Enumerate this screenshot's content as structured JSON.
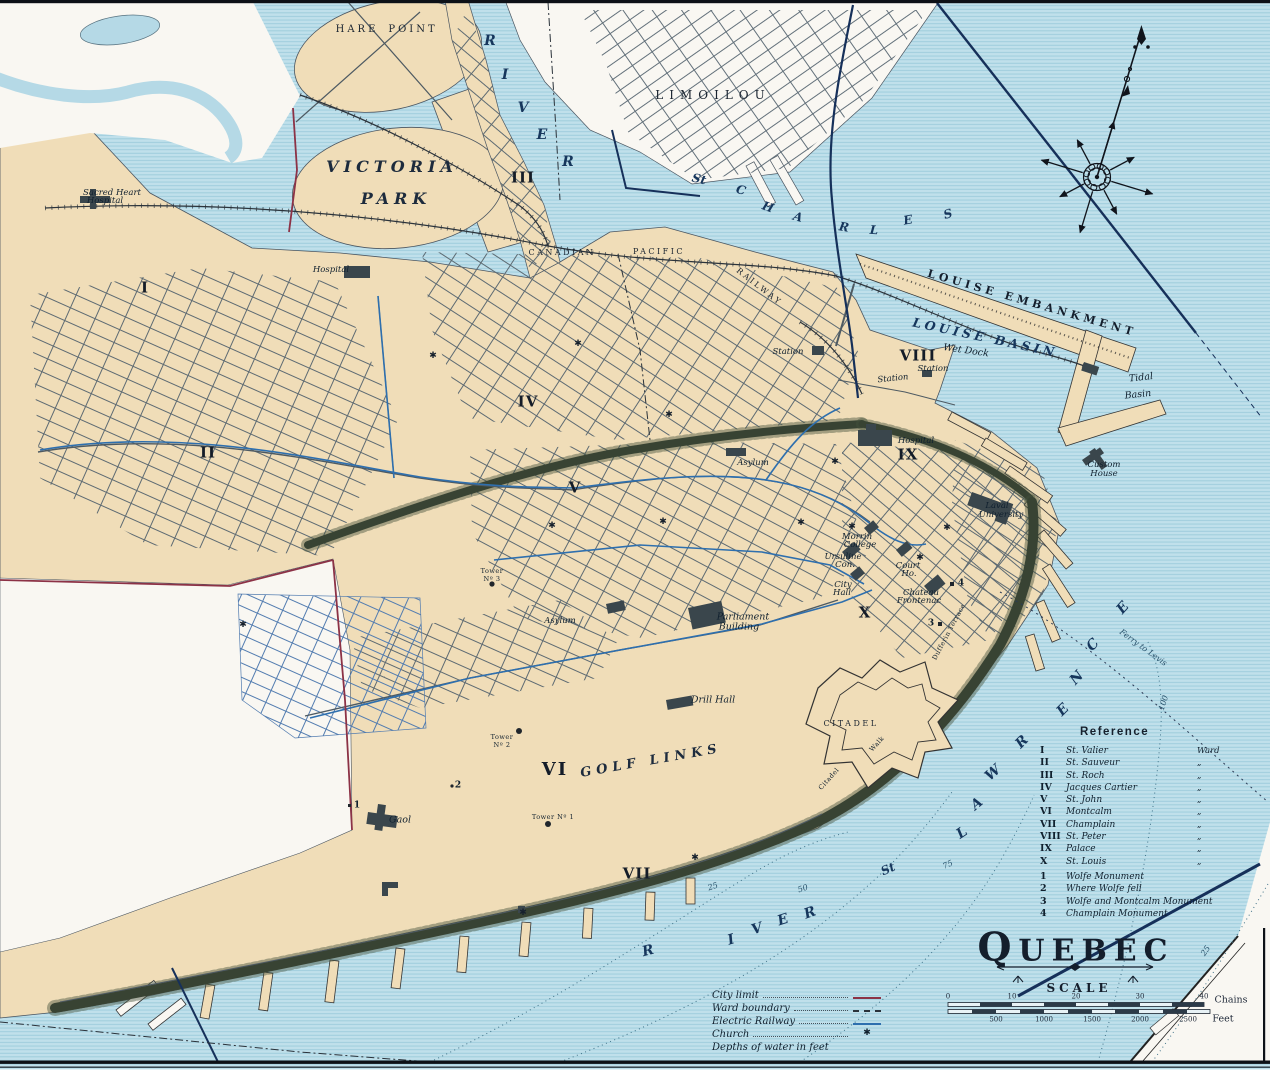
{
  "map": {
    "title": "QUEBEC",
    "scale_heading": "SCALE",
    "scale_bar": {
      "chains_ticks": [
        "0",
        "10",
        "20",
        "30",
        "40"
      ],
      "chains_unit": "Chains",
      "feet_ticks": [
        "500",
        "1000",
        "1500",
        "2000",
        "2500"
      ],
      "feet_unit": "Feet"
    },
    "colors": {
      "water": "#c0e0eb",
      "water_line": "#99cadb",
      "land": "#f0ddb8",
      "white_area": "#f9f7f2",
      "cliff": "#2e382c",
      "ink": "#1e2838",
      "electric_railway": "#2e6fae",
      "city_limit": "#8c3246",
      "navy": "#16305a"
    },
    "legend": [
      {
        "label": "City limit",
        "swatch": "maroon"
      },
      {
        "label": "Ward boundary",
        "swatch": "dash"
      },
      {
        "label": "Electric Railway",
        "swatch": "blue"
      },
      {
        "label": "Church",
        "swatch": "church"
      },
      {
        "label": "Depths of water in feet",
        "swatch": "none"
      }
    ],
    "reference": {
      "heading": "Reference",
      "wards": [
        {
          "numeral": "I",
          "name": "St. Valier",
          "suffix": "Ward"
        },
        {
          "numeral": "II",
          "name": "St. Sauveur",
          "suffix": "„"
        },
        {
          "numeral": "III",
          "name": "St. Roch",
          "suffix": "„"
        },
        {
          "numeral": "IV",
          "name": "Jacques Cartier",
          "suffix": "„"
        },
        {
          "numeral": "V",
          "name": "St. John",
          "suffix": "„"
        },
        {
          "numeral": "VI",
          "name": "Montcalm",
          "suffix": "„"
        },
        {
          "numeral": "VII",
          "name": "Champlain",
          "suffix": "„"
        },
        {
          "numeral": "VIII",
          "name": "St. Peter",
          "suffix": "„"
        },
        {
          "numeral": "IX",
          "name": "Palace",
          "suffix": "„"
        },
        {
          "numeral": "X",
          "name": "St. Louis",
          "suffix": "„"
        }
      ],
      "monuments": [
        {
          "num": "1",
          "name": "Wolfe Monument"
        },
        {
          "num": "2",
          "name": "Where Wolfe fell"
        },
        {
          "num": "3",
          "name": "Wolfe and Montcalm Monument"
        },
        {
          "num": "4",
          "name": "Champlain Monument"
        }
      ]
    },
    "churches": [
      [
        433,
        356
      ],
      [
        578,
        344
      ],
      [
        669,
        415
      ],
      [
        552,
        526
      ],
      [
        663,
        522
      ],
      [
        801,
        523
      ],
      [
        835,
        462
      ],
      [
        852,
        527
      ],
      [
        920,
        558
      ],
      [
        947,
        528
      ],
      [
        243,
        625
      ],
      [
        695,
        858
      ],
      [
        523,
        913
      ]
    ],
    "labels": [
      {
        "t": "HARE",
        "x": 357,
        "y": 30,
        "c": "dist10"
      },
      {
        "t": "POINT",
        "x": 413,
        "y": 30,
        "c": "dist10"
      },
      {
        "t": "VICTORIA",
        "x": 392,
        "y": 167,
        "c": "park"
      },
      {
        "t": "PARK",
        "x": 396,
        "y": 199,
        "c": "park"
      },
      {
        "t": "R",
        "x": 490,
        "y": 41,
        "c": "wl"
      },
      {
        "t": "I",
        "x": 505,
        "y": 75,
        "c": "wl"
      },
      {
        "t": "V",
        "x": 523,
        "y": 108,
        "c": "wl"
      },
      {
        "t": "E",
        "x": 542,
        "y": 135,
        "c": "wl"
      },
      {
        "t": "R",
        "x": 568,
        "y": 162,
        "c": "wl"
      },
      {
        "t": "III",
        "x": 523,
        "y": 178,
        "c": "ward"
      },
      {
        "t": "LIMOILOU",
        "x": 713,
        "y": 95,
        "c": "dist12"
      },
      {
        "t": "St",
        "x": 699,
        "y": 179,
        "c": "wl2",
        "r": 12
      },
      {
        "t": "C",
        "x": 741,
        "y": 190,
        "c": "wl2",
        "r": 16
      },
      {
        "t": "H",
        "x": 768,
        "y": 207,
        "c": "wl2",
        "r": 20
      },
      {
        "t": "A",
        "x": 798,
        "y": 217,
        "c": "wl2",
        "r": 16
      },
      {
        "t": "R",
        "x": 844,
        "y": 227,
        "c": "wl2",
        "r": 10
      },
      {
        "t": "L",
        "x": 874,
        "y": 230,
        "c": "wl2",
        "r": 4
      },
      {
        "t": "E",
        "x": 908,
        "y": 220,
        "c": "wl2",
        "r": -10
      },
      {
        "t": "S",
        "x": 948,
        "y": 214,
        "c": "wl2",
        "r": -16
      },
      {
        "t": "CANADIAN",
        "x": 562,
        "y": 253,
        "c": "dist8"
      },
      {
        "t": "PACIFIC",
        "x": 659,
        "y": 252,
        "c": "dist8"
      },
      {
        "t": "RAILWAY",
        "x": 759,
        "y": 287,
        "c": "dist8",
        "r": 38
      },
      {
        "t": "Station",
        "x": 788,
        "y": 352,
        "c": "place8"
      },
      {
        "t": "Station",
        "x": 893,
        "y": 379,
        "c": "place8",
        "r": -6
      },
      {
        "t": "VIII",
        "x": 918,
        "y": 356,
        "c": "ward"
      },
      {
        "t": "Station",
        "x": 933,
        "y": 369,
        "c": "place8"
      },
      {
        "t": "LOUISE  EMBANKMENT",
        "x": 1032,
        "y": 303,
        "c": "emb",
        "r": 16
      },
      {
        "t": "LOUISE  BASIN",
        "x": 985,
        "y": 338,
        "c": "wm",
        "r": 12
      },
      {
        "t": "Wet Dock",
        "x": 966,
        "y": 351,
        "c": "place",
        "r": 8
      },
      {
        "t": "Tidal",
        "x": 1141,
        "y": 378,
        "c": "place",
        "r": -6
      },
      {
        "t": "Basin",
        "x": 1138,
        "y": 395,
        "c": "place",
        "r": -6
      },
      {
        "t": "Custom",
        "x": 1104,
        "y": 465,
        "c": "place8"
      },
      {
        "t": "House",
        "x": 1104,
        "y": 474,
        "c": "place8"
      },
      {
        "t": "Hospital",
        "x": 916,
        "y": 441,
        "c": "place8"
      },
      {
        "t": "IX",
        "x": 908,
        "y": 455,
        "c": "ward"
      },
      {
        "t": "Laval",
        "x": 997,
        "y": 506,
        "c": "place8"
      },
      {
        "t": "University",
        "x": 1001,
        "y": 515,
        "c": "place8"
      },
      {
        "t": "Asylum",
        "x": 753,
        "y": 463,
        "c": "place8"
      },
      {
        "t": "Morrin",
        "x": 857,
        "y": 537,
        "c": "place8"
      },
      {
        "t": "College",
        "x": 860,
        "y": 545,
        "c": "place8"
      },
      {
        "t": "Ursuline",
        "x": 843,
        "y": 557,
        "c": "place8"
      },
      {
        "t": "Con.",
        "x": 845,
        "y": 565,
        "c": "place8"
      },
      {
        "t": "Court",
        "x": 908,
        "y": 566,
        "c": "place8"
      },
      {
        "t": "Ho.",
        "x": 909,
        "y": 574,
        "c": "place8"
      },
      {
        "t": "City",
        "x": 843,
        "y": 585,
        "c": "place8"
      },
      {
        "t": "Hall",
        "x": 842,
        "y": 593,
        "c": "place8"
      },
      {
        "t": "Chateau",
        "x": 921,
        "y": 593,
        "c": "place8"
      },
      {
        "t": "Frontenac",
        "x": 919,
        "y": 601,
        "c": "place8"
      },
      {
        "t": "4",
        "x": 961,
        "y": 584,
        "c": "marker"
      },
      {
        "t": "3",
        "x": 931,
        "y": 624,
        "c": "marker"
      },
      {
        "t": "X",
        "x": 865,
        "y": 613,
        "c": "ward"
      },
      {
        "t": "Dufferin Terrace",
        "x": 949,
        "y": 632,
        "c": "tiny",
        "r": -62
      },
      {
        "t": "Parliament",
        "x": 743,
        "y": 617,
        "c": "place"
      },
      {
        "t": "Building",
        "x": 739,
        "y": 627,
        "c": "place"
      },
      {
        "t": "Asylum",
        "x": 560,
        "y": 621,
        "c": "place8"
      },
      {
        "t": "Drill Hall",
        "x": 713,
        "y": 700,
        "c": "place"
      },
      {
        "t": "CITADEL",
        "x": 851,
        "y": 724,
        "c": "dist8"
      },
      {
        "t": "Citadel",
        "x": 829,
        "y": 779,
        "c": "tiny",
        "r": -48
      },
      {
        "t": "Walk",
        "x": 877,
        "y": 744,
        "c": "tiny",
        "r": -48
      },
      {
        "t": "VI",
        "x": 555,
        "y": 770,
        "c": "wardlg"
      },
      {
        "t": "GOLF  LINKS",
        "x": 651,
        "y": 761,
        "c": "golf",
        "r": -10
      },
      {
        "t": "Tower",
        "x": 492,
        "y": 571,
        "c": "tiny"
      },
      {
        "t": "Nº 3",
        "x": 492,
        "y": 579,
        "c": "tiny"
      },
      {
        "t": "Tower",
        "x": 502,
        "y": 737,
        "c": "tiny"
      },
      {
        "t": "Nº 2",
        "x": 502,
        "y": 745,
        "c": "tiny"
      },
      {
        "t": "Tower Nº 1",
        "x": 553,
        "y": 817,
        "c": "tiny"
      },
      {
        "t": "Gaol",
        "x": 400,
        "y": 820,
        "c": "place"
      },
      {
        "t": "1",
        "x": 357,
        "y": 806,
        "c": "marker"
      },
      {
        "t": "2",
        "x": 458,
        "y": 786,
        "c": "marker"
      },
      {
        "t": "I",
        "x": 145,
        "y": 288,
        "c": "ward"
      },
      {
        "t": "II",
        "x": 208,
        "y": 453,
        "c": "ward"
      },
      {
        "t": "IV",
        "x": 528,
        "y": 402,
        "c": "ward"
      },
      {
        "t": "V",
        "x": 575,
        "y": 488,
        "c": "ward"
      },
      {
        "t": "VII",
        "x": 637,
        "y": 874,
        "c": "ward"
      },
      {
        "t": "Sacred Heart",
        "x": 112,
        "y": 193,
        "c": "place8"
      },
      {
        "t": "Hospital",
        "x": 105,
        "y": 201,
        "c": "place8"
      },
      {
        "t": "Hospital",
        "x": 331,
        "y": 270,
        "c": "place8"
      },
      {
        "t": "R",
        "x": 648,
        "y": 951,
        "c": "wl",
        "r": -14
      },
      {
        "t": "I",
        "x": 731,
        "y": 940,
        "c": "wl",
        "r": -16
      },
      {
        "t": "V",
        "x": 757,
        "y": 929,
        "c": "wl",
        "r": -18
      },
      {
        "t": "E",
        "x": 783,
        "y": 920,
        "c": "wl",
        "r": -18
      },
      {
        "t": "R",
        "x": 810,
        "y": 913,
        "c": "wl",
        "r": -20
      },
      {
        "t": "St",
        "x": 888,
        "y": 869,
        "c": "wl2",
        "r": -24
      },
      {
        "t": "L",
        "x": 962,
        "y": 833,
        "c": "wl",
        "r": -34
      },
      {
        "t": "A",
        "x": 977,
        "y": 804,
        "c": "wl",
        "r": -40
      },
      {
        "t": "W",
        "x": 993,
        "y": 773,
        "c": "wl",
        "r": -42
      },
      {
        "t": "R",
        "x": 1022,
        "y": 742,
        "c": "wl",
        "r": -45
      },
      {
        "t": "E",
        "x": 1063,
        "y": 710,
        "c": "wl",
        "r": -45
      },
      {
        "t": "N",
        "x": 1077,
        "y": 678,
        "c": "wl",
        "r": -47
      },
      {
        "t": "C",
        "x": 1093,
        "y": 645,
        "c": "wl",
        "r": -47
      },
      {
        "t": "E",
        "x": 1123,
        "y": 608,
        "c": "wl",
        "r": -48
      },
      {
        "t": "Ferry to Levis",
        "x": 1143,
        "y": 648,
        "c": "depth",
        "r": 36
      },
      {
        "t": "25",
        "x": 713,
        "y": 887,
        "c": "depth",
        "r": -18
      },
      {
        "t": "50",
        "x": 803,
        "y": 889,
        "c": "depth",
        "r": -18
      },
      {
        "t": "75",
        "x": 948,
        "y": 865,
        "c": "depth",
        "r": -25
      },
      {
        "t": "100",
        "x": 1164,
        "y": 703,
        "c": "depth",
        "r": -72
      },
      {
        "t": "25",
        "x": 1206,
        "y": 951,
        "c": "depth",
        "r": -55
      },
      {
        "t": "QUEBEC",
        "x": 1076,
        "y": 948,
        "c": "title",
        "n": "map-title"
      },
      {
        "t": "SCALE",
        "x": 1079,
        "y": 988,
        "c": "scaleword",
        "n": "scale-heading"
      },
      {
        "t": "0",
        "x": 948,
        "y": 997,
        "c": "tick"
      },
      {
        "t": "10",
        "x": 1012,
        "y": 997,
        "c": "tick"
      },
      {
        "t": "20",
        "x": 1076,
        "y": 997,
        "c": "tick"
      },
      {
        "t": "30",
        "x": 1140,
        "y": 997,
        "c": "tick"
      },
      {
        "t": "40",
        "x": 1204,
        "y": 997,
        "c": "tick"
      },
      {
        "t": "Chains",
        "x": 1231,
        "y": 1000,
        "c": "unit"
      },
      {
        "t": "500",
        "x": 996,
        "y": 1020,
        "c": "tick"
      },
      {
        "t": "1000",
        "x": 1044,
        "y": 1020,
        "c": "tick"
      },
      {
        "t": "1500",
        "x": 1092,
        "y": 1020,
        "c": "tick"
      },
      {
        "t": "2000",
        "x": 1140,
        "y": 1020,
        "c": "tick"
      },
      {
        "t": "2500",
        "x": 1188,
        "y": 1020,
        "c": "tick"
      },
      {
        "t": "Feet",
        "x": 1223,
        "y": 1019,
        "c": "unit"
      }
    ]
  }
}
